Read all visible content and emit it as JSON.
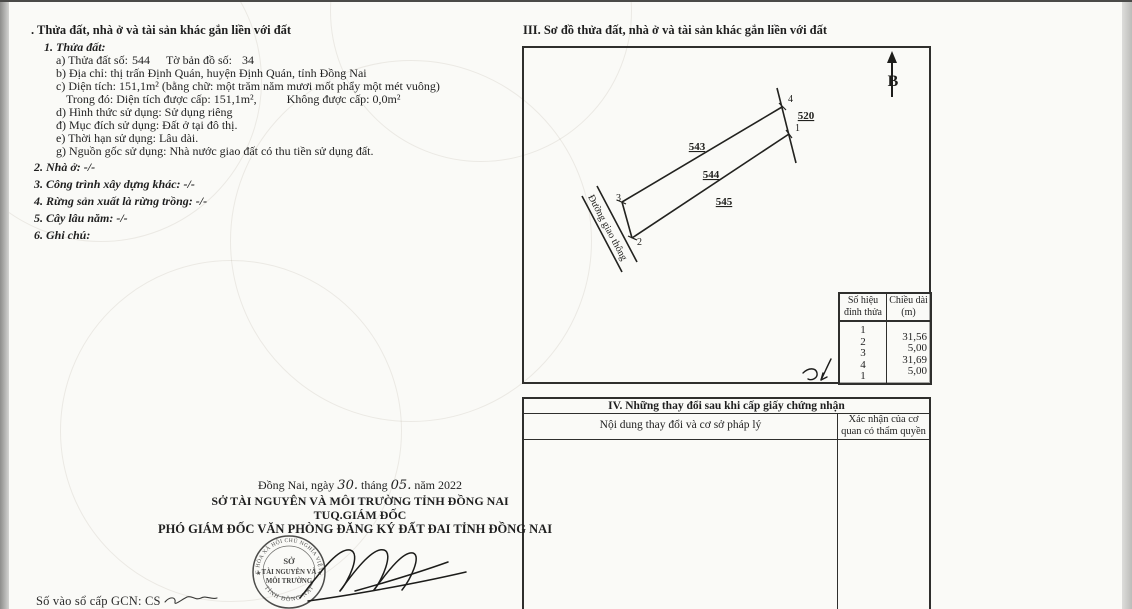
{
  "section_parcel": {
    "title": ". Thửa đất, nhà ở và tài sản khác gắn liền với đất",
    "heading1": "1. Thửa đất:",
    "line_a_label": "a) Thửa đất số:",
    "line_a_value": "544",
    "line_a2_label": "Tờ bản đồ số:",
    "line_a2_value": "34",
    "line_b": "b) Địa chỉ: thị trấn Định Quán, huyện Định Quán, tỉnh Đồng Nai",
    "line_c": "c) Diện tích: 151,1m² (bằng chữ: một trăm năm mươi mốt phẩy một mét vuông)",
    "line_c2_label": "Trong đó: Diện tích được cấp: 151,1m²,",
    "line_c2_value": "Không được cấp: 0,0m²",
    "line_d": "d) Hình thức sử dụng: Sử dụng riêng",
    "line_dd": "đ) Mục đích sử dụng: Đất ở tại đô thị.",
    "line_e": "e) Thời hạn sử dụng: Lâu dài.",
    "line_g": "g) Nguồn gốc sử dụng: Nhà nước giao đất có thu tiền sử dụng đất.",
    "item2": "2. Nhà ở: -/-",
    "item3": "3. Công trình xây dựng khác:  -/-",
    "item4": "4. Rừng sản xuất là rừng trồng: -/-",
    "item5": "5. Cây lâu năm: -/-",
    "item6": "6. Ghi chú:"
  },
  "section_map": {
    "title": "III. Sơ đồ thửa đất, nhà ở và tài sản khác gắn liền với đất",
    "north_label": "B",
    "road_label": "Đường giao thông",
    "parcel_520": "520",
    "parcel_543": "543",
    "parcel_544": "544",
    "parcel_545": "545",
    "vertex_1": "1",
    "vertex_2": "2",
    "vertex_3": "3",
    "vertex_4": "4"
  },
  "vertex_table": {
    "col_vertex_line1": "Số hiệu",
    "col_vertex_line2": "đỉnh thửa",
    "col_length_line1": "Chiều dài",
    "col_length_line2": "(m)",
    "vertex_ids": [
      "1",
      "2",
      "3",
      "4",
      "1"
    ],
    "lengths": [
      "31,56",
      "5,00",
      "31,69",
      "5,00"
    ]
  },
  "section_changes": {
    "title": "IV. Những thay đổi sau khi cấp giấy chứng nhận",
    "col_content": "Nội dung thay đổi và cơ sở pháp lý",
    "col_confirm_line1": "Xác nhận của cơ",
    "col_confirm_line2": "quan có thẩm quyền"
  },
  "signature_block": {
    "date_place": "Đồng Nai, ngày",
    "date_day": "30.",
    "date_thang": "tháng",
    "date_month": "05.",
    "date_year": "năm 2022",
    "org_name": "SỞ TÀI NGUYÊN VÀ MÔI TRƯỜNG TỈNH ĐỒNG NAI",
    "authority": "TUQ.GIÁM ĐỐC",
    "signer_title": "PHÓ GIÁM ĐỐC VĂN PHÒNG ĐĂNG KÝ ĐẤT ĐAI TỈNH ĐỒNG NAI"
  },
  "stamp": {
    "ring_top": "CỘNG HÒA XÃ HỘI CHỦ NGHĨA VIỆT NAM",
    "center_line1": "SỞ",
    "center_line2": "TÀI NGUYÊN VÀ",
    "center_line3": "MÔI TRƯỜNG",
    "ring_bottom": "TỈNH ĐỒNG NAI",
    "star": "★"
  },
  "footer": {
    "registry_label": "Số vào sổ cấp GCN: CS"
  },
  "colors": {
    "ink": "#1f1f1f",
    "paper": "#fafaf7",
    "border": "#2f2f2d"
  }
}
